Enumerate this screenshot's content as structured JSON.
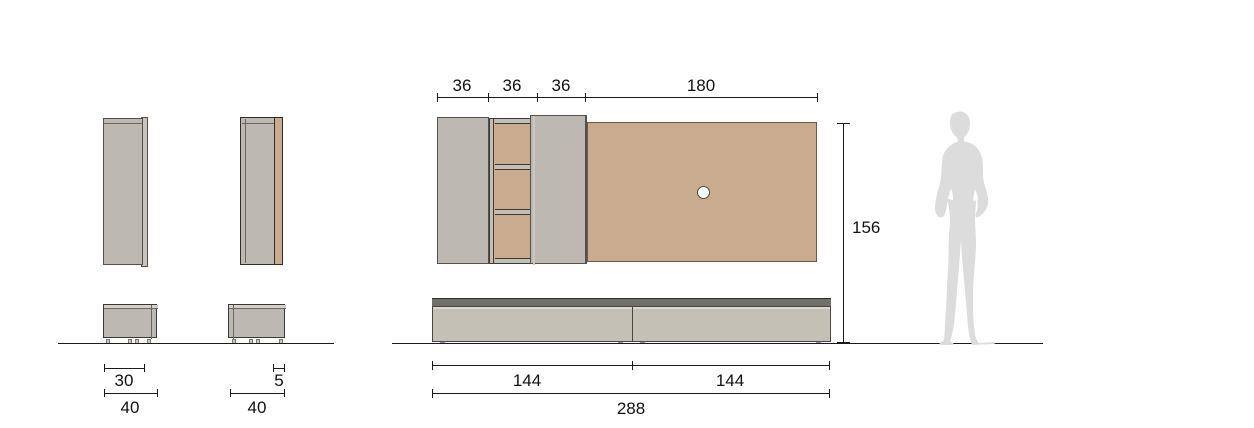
{
  "labels": {
    "col1_top": "30",
    "col1_total": "40",
    "col2_top": "5",
    "col2_total": "40",
    "top_segments": [
      "36",
      "36",
      "36",
      "180"
    ],
    "height": "156",
    "bottom_left": "144",
    "bottom_right": "144",
    "bottom_total": "288"
  },
  "colors": {
    "tan": "#c9ac90",
    "cabinet_gray": "#bdb8b2",
    "bench_front": "#c5c0b6",
    "bench_top": "#70706a",
    "frame_light": "#c3beb6",
    "silhouette": "#dcdcdc",
    "line": "#1a1a1a"
  }
}
